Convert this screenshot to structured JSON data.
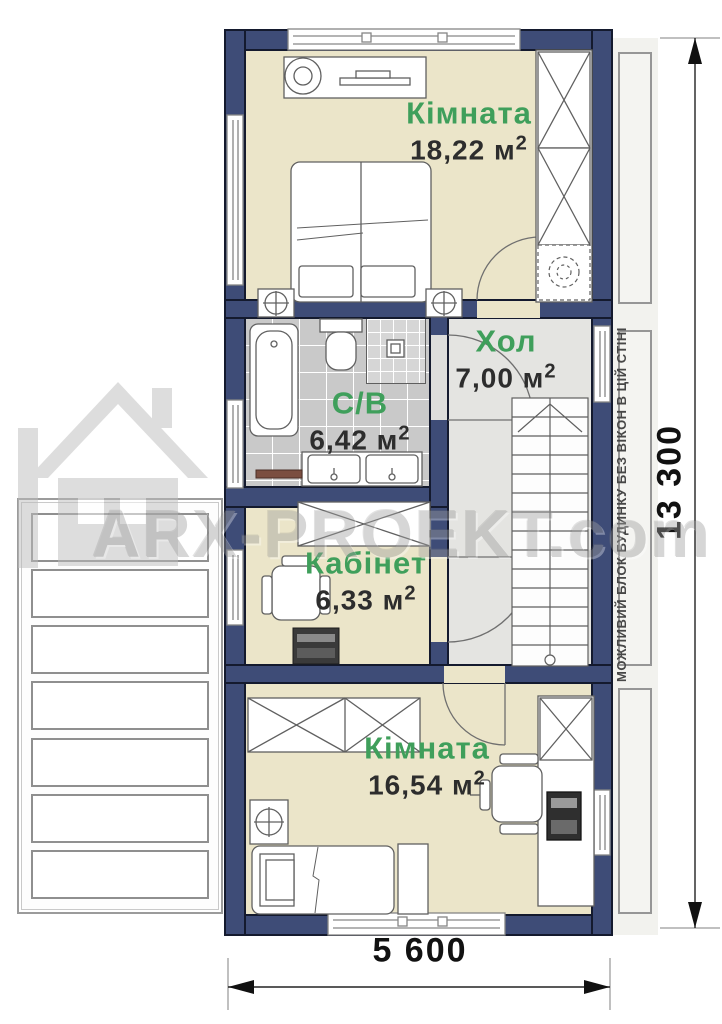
{
  "rooms": [
    {
      "key": "bedroom-top",
      "name": "Кімната",
      "area": "18,22 м",
      "area_sup": "2"
    },
    {
      "key": "bathroom",
      "name": "С/В",
      "area": "6,42 м",
      "area_sup": "2"
    },
    {
      "key": "hall",
      "name": "Хол",
      "area": "7,00 м",
      "area_sup": "2"
    },
    {
      "key": "office",
      "name": "Кабінет",
      "area": "6,33 м",
      "area_sup": "2"
    },
    {
      "key": "bedroom-bottom",
      "name": "Кімната",
      "area": "16,54 м",
      "area_sup": "2"
    }
  ],
  "dimensions": {
    "vertical": "13 300",
    "horizontal": "5 600"
  },
  "side_note": "МОЖЛИВИЙ БЛОК БУДИНКУ БЕЗ ВІКОН В ЦІЙ СТІНІ",
  "watermark": "ARX-PROEKT.com",
  "colors": {
    "wall": "#3E4C77",
    "room_floor": "#EBE5C9",
    "tile_floor": "#C9C9C9",
    "hall_floor": "#E4E4E1",
    "room_name_green": "#3F9F5B",
    "area_text": "#2d2d2d",
    "dimension_text": "#111111"
  }
}
